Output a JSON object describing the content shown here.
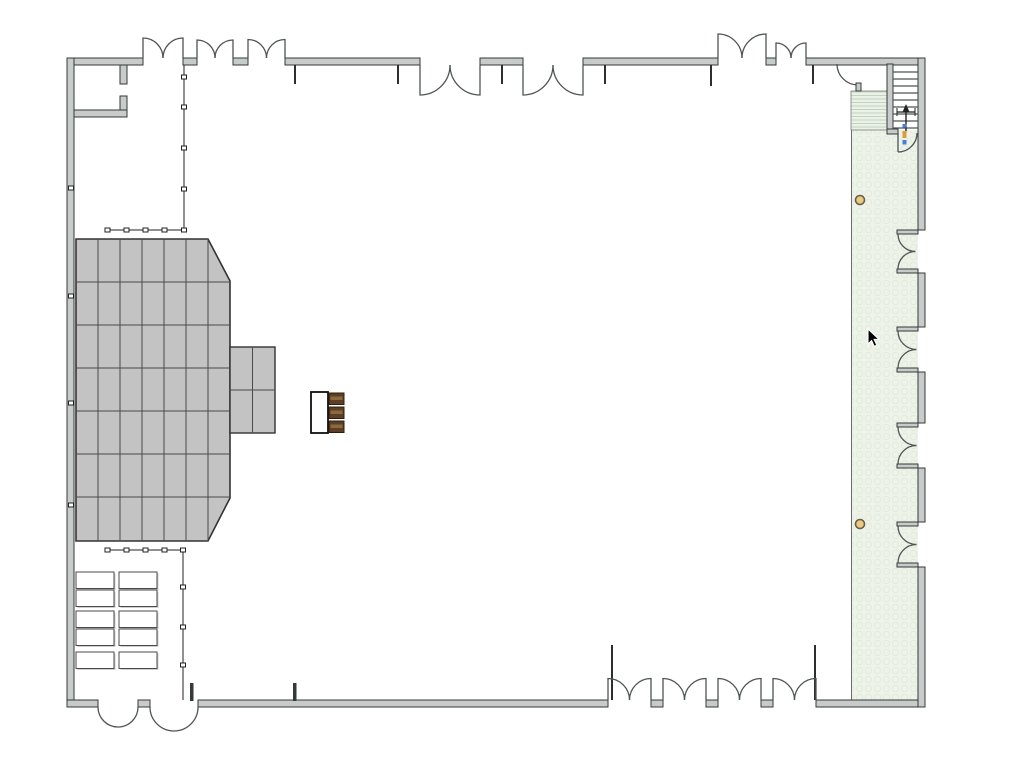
{
  "app": {
    "name": "event-floor-plan-canvas",
    "view": "banquet-hall-layout"
  },
  "canvas": {
    "width": 1024,
    "height": 761,
    "background": "#ffffff"
  },
  "colors": {
    "wallFill": "#c7cbc9",
    "wallStroke": "#343a39",
    "doorArc": "#4f5554",
    "thinLine": "#2e2e2e",
    "stageTileFill": "#c3c3c3",
    "stageGrid": "#4a4a4a",
    "stageOutline": "#333333",
    "corridorFill": "#eef3e9",
    "corridorTexture": "#e2ebdc",
    "hatchFill": "#eaf1e6",
    "hatchLine": "#c5d2c1",
    "tableFill": "#ffffff",
    "tableStroke": "#4a4a4a",
    "tableShadow": "#a8a8a8",
    "chairBrown": "#5c3f24",
    "chairBrownLight": "#8a6a42",
    "chairBrownDark": "#2f1d0e",
    "postFill": "#ecca7e",
    "postStroke": "#6b5e46",
    "drapeLine": "#222222",
    "markerBlue": "#4a7fd4",
    "markerOrange": "#e09a3c",
    "cursorFill": "#000000",
    "cursorOutline": "#ffffff"
  },
  "cursor": {
    "type": "arrow",
    "x": 868,
    "y": 329
  },
  "objects": {
    "stage_platform": {
      "type": "tiled-platform",
      "shape": "beveled-rectangle",
      "grid_cols": 7,
      "grid_rows": 7
    },
    "stage_extension": {
      "type": "tiled-platform",
      "grid_cols": 2,
      "grid_rows": 2
    },
    "banquet_tables": {
      "count": 10,
      "layout": "2 columns x 5 rows"
    },
    "head_table": {
      "type": "rectangular-table",
      "chairs": 3
    },
    "pipe_and_drape": {
      "runs": 2,
      "wall_anchors": 4
    },
    "posts": {
      "count": 2
    },
    "staircase": {
      "treads": 8,
      "direction": "up"
    },
    "doors": {
      "top_wall_double_doors": 7,
      "bottom_wall_double_doors": 6,
      "right_wall_double_doors": 4,
      "single_doors": 2
    }
  }
}
